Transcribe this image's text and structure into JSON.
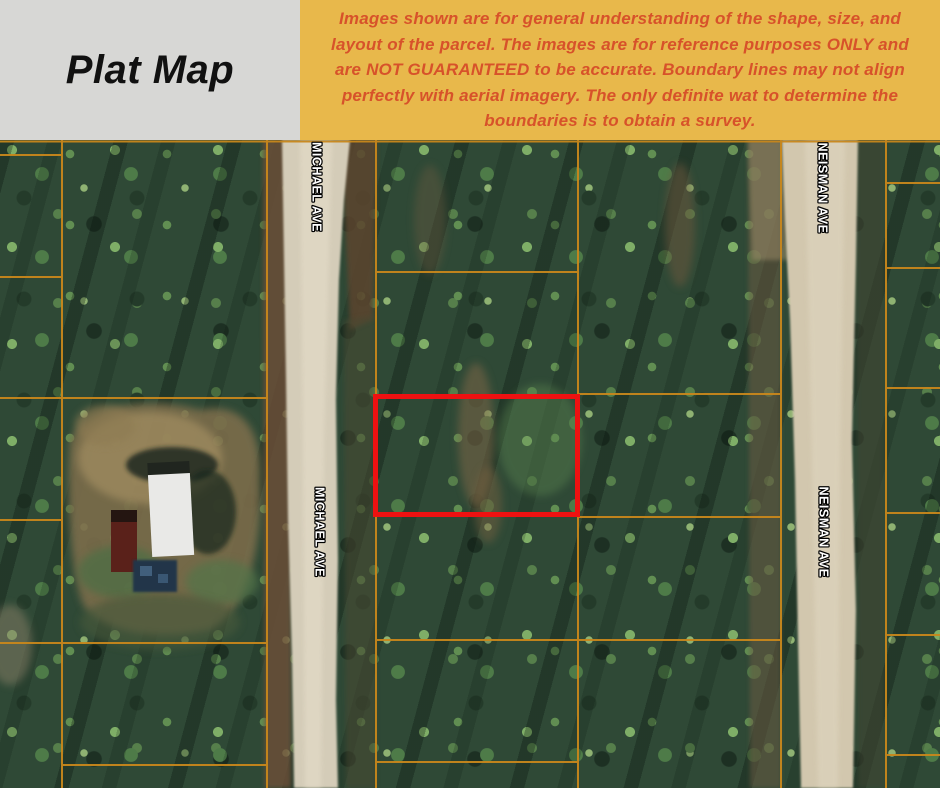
{
  "header": {
    "title": "Plat Map"
  },
  "disclaimer": {
    "lines": [
      "Images shown are for general understanding of the shape, size, and",
      "layout of the parcel. The images are for reference purposes ONLY and",
      "are NOT GUARANTEED to be accurate. Boundary lines may not align",
      "perfectly with aerial imagery. The only definite wat to determine the",
      "boundaries is to obtain a survey."
    ]
  },
  "map": {
    "streets": {
      "michael": "MICHAEL AVE",
      "neisman": "NEISMAN AVE"
    }
  },
  "colors": {
    "header_bg": "#d7d7d5",
    "banner_bg": "#e8b84b",
    "disclaimer_text": "#d7522a",
    "parcel_line": "#c8871b",
    "highlight": "#ee1111"
  }
}
